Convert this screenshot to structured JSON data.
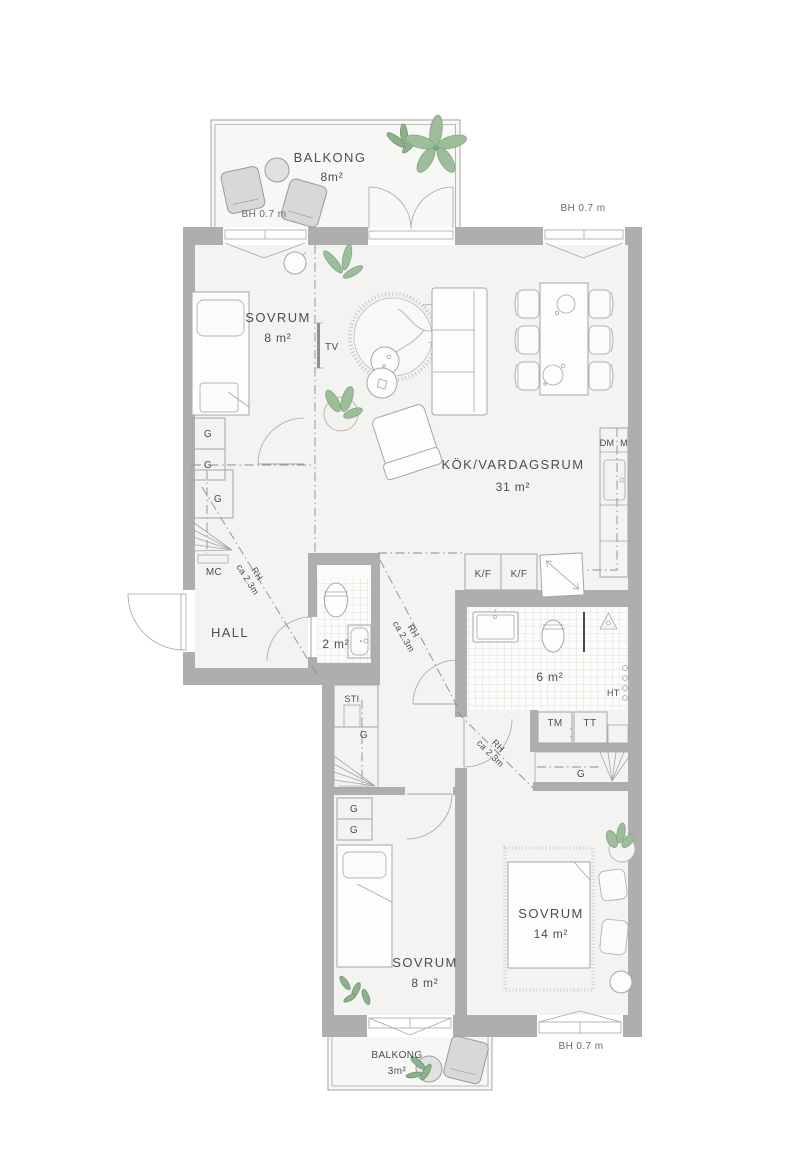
{
  "plan": {
    "rooms": {
      "balcony_top": {
        "label": "BALKONG",
        "area": "8m²"
      },
      "bedroom_nw": {
        "label": "SOVRUM",
        "area": "8 m²"
      },
      "kitchen_living": {
        "label": "KÖK/VARDAGSRUM",
        "area": "31 m²"
      },
      "hall": {
        "label": "HALL"
      },
      "wc": {
        "area": "2 m²"
      },
      "bathroom": {
        "area": "6 m²"
      },
      "bedroom_sw": {
        "label": "SOVRUM",
        "area": "8 m²"
      },
      "bedroom_se": {
        "label": "SOVRUM",
        "area": "14 m²"
      },
      "balcony_bottom": {
        "label": "BALKONG",
        "area": "3m²"
      }
    },
    "fixtures": {
      "tv": "TV",
      "dishwasher": "DM",
      "micro": "M",
      "fridge_freezer": [
        "K/F",
        "K/F"
      ],
      "mc": "MC",
      "sti": "STI",
      "washer": "TM",
      "dryer": "TT",
      "towel_rail": "HT",
      "wardrobe": "G"
    },
    "annotations": {
      "bh": [
        "BH 0.7 m",
        "BH 0.7 m",
        "BH 0.7 m"
      ],
      "rh": [
        {
          "l1": "RH",
          "l2": "ca 2.3m"
        },
        {
          "l1": "RH",
          "l2": "ca 2.3m"
        },
        {
          "l1": "RH",
          "l2": "ca 2.3m"
        }
      ]
    },
    "colors": {
      "wall": "#aeaeae",
      "floor": "#f3f3f1",
      "balcony_floor": "#f7f7f5",
      "line": "#a6a6a4",
      "tile_line": "#ddd7d1",
      "plant": "#9dbd9b",
      "text": "#4d4d4d"
    }
  }
}
